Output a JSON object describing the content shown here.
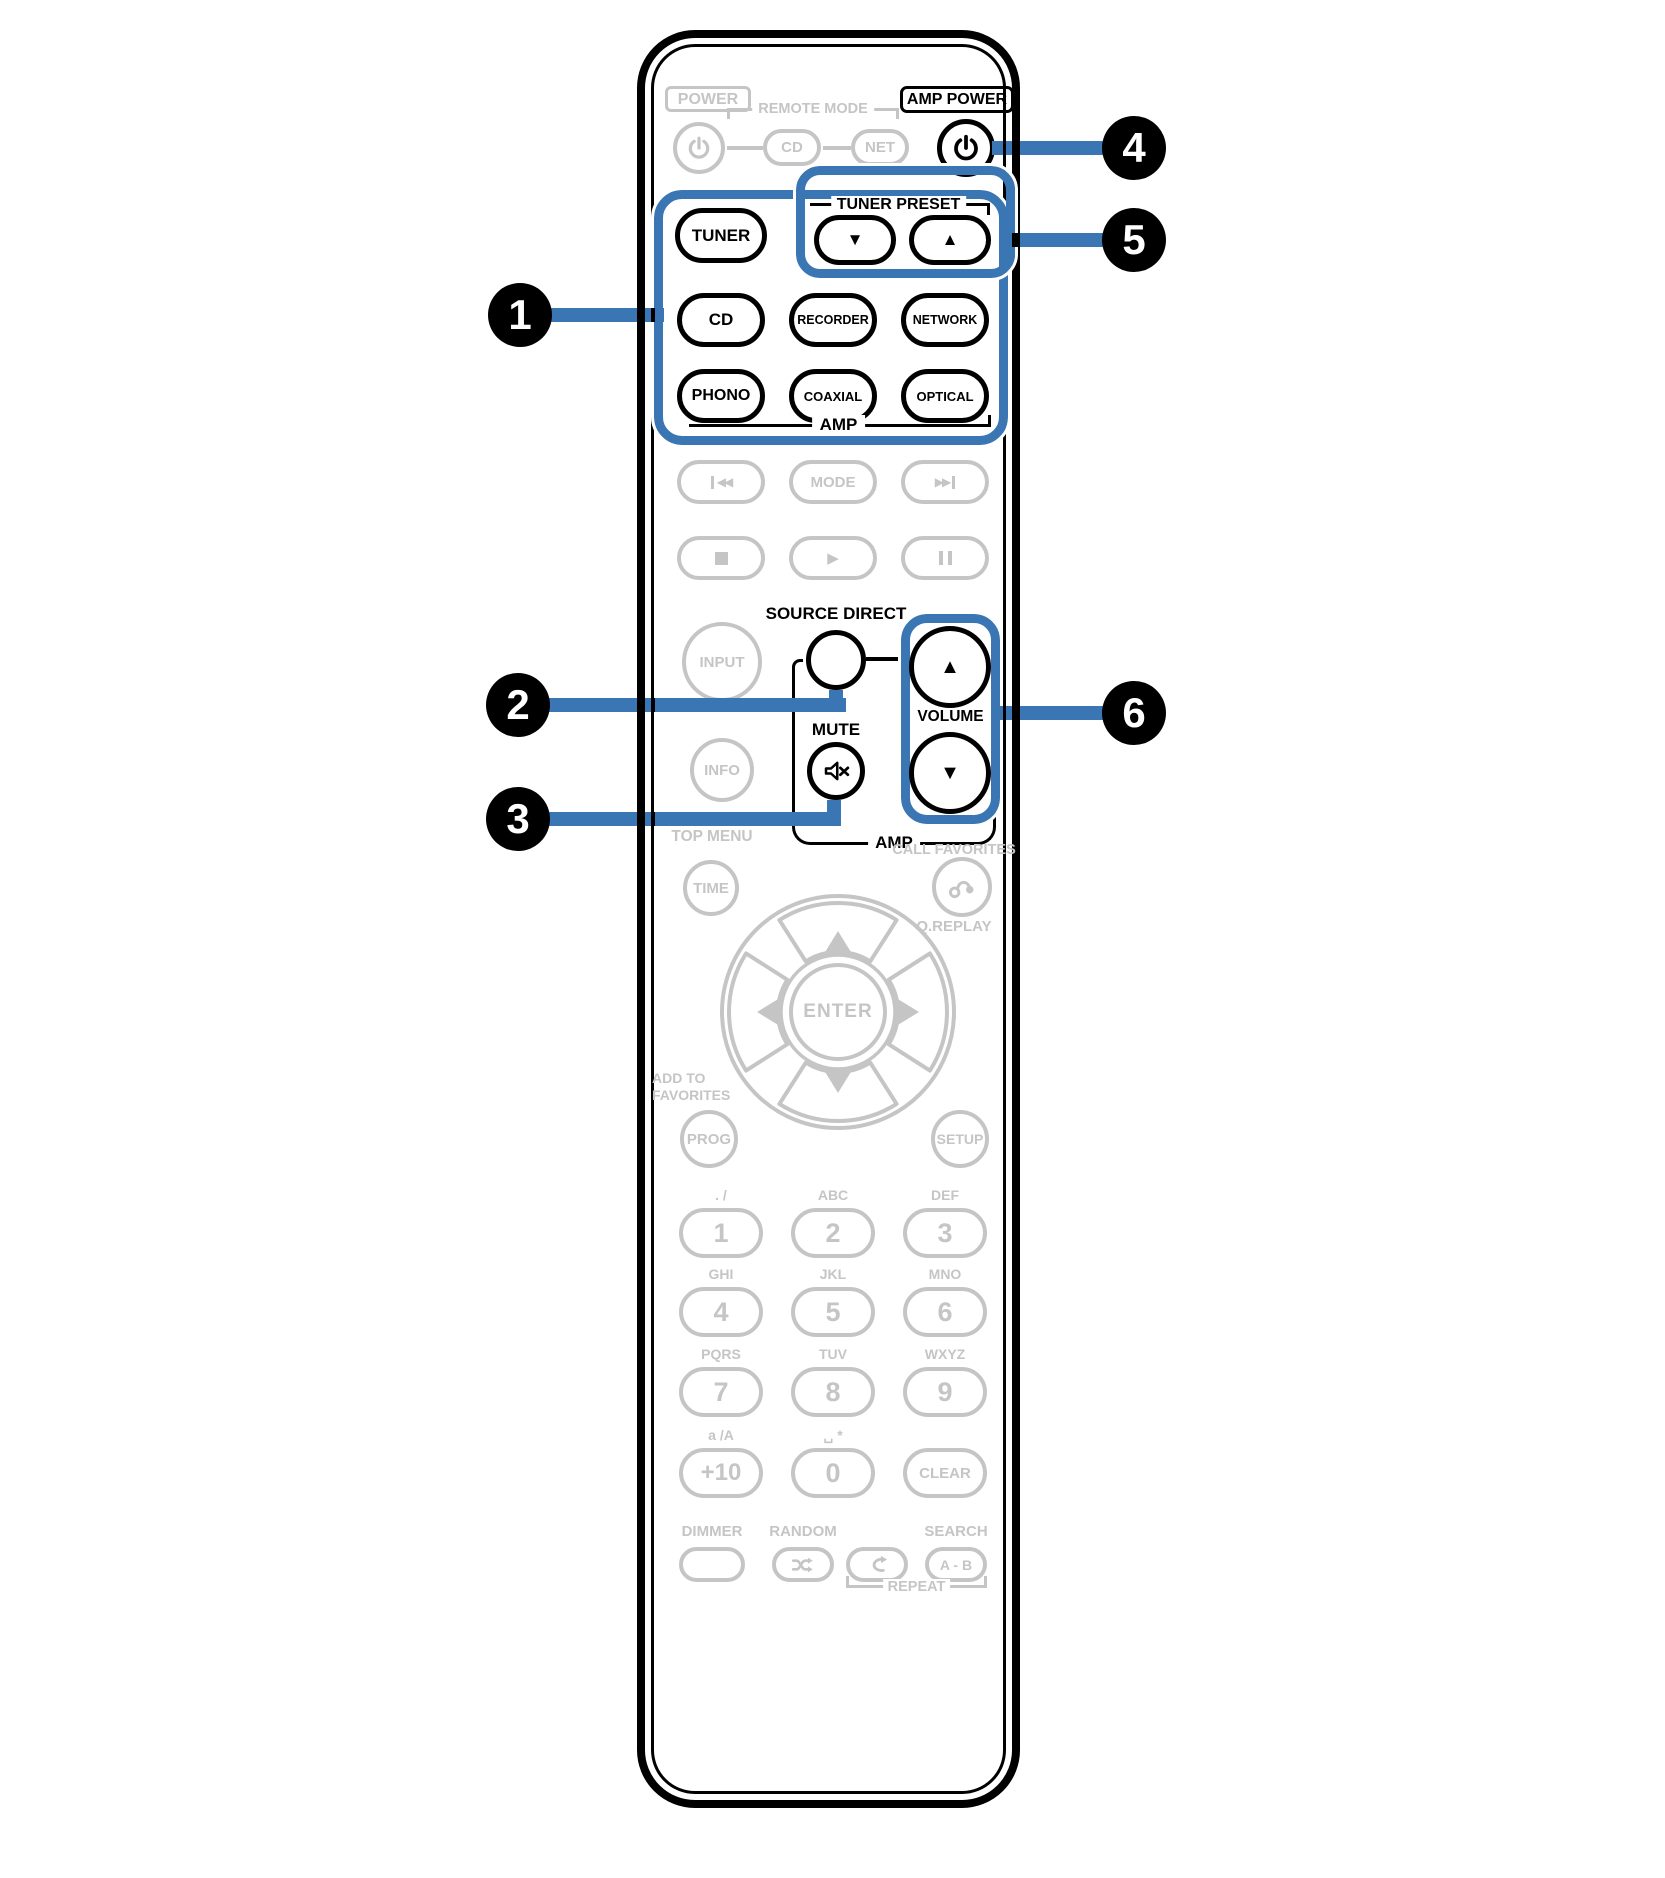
{
  "colors": {
    "accent_blue": "#3b76b4",
    "inactive_grey": "#c5c5c5",
    "active_black": "#000000"
  },
  "callouts": [
    {
      "number": "1"
    },
    {
      "number": "2"
    },
    {
      "number": "3"
    },
    {
      "number": "4"
    },
    {
      "number": "5"
    },
    {
      "number": "6"
    }
  ],
  "top": {
    "power_label": "POWER",
    "remote_mode_label": "REMOTE MODE",
    "cd_mode_button": "CD",
    "net_mode_button": "NET",
    "amp_power_label": "AMP POWER"
  },
  "tuner_preset": {
    "label": "TUNER PRESET",
    "down_glyph": "▼",
    "up_glyph": "▲"
  },
  "sources": {
    "tuner": "TUNER",
    "cd": "CD",
    "recorder": "RECORDER",
    "network": "NETWORK",
    "phono": "PHONO",
    "coaxial": "COAXIAL",
    "optical": "OPTICAL",
    "group_label": "AMP"
  },
  "transport": {
    "prev_glyph": "◀◀",
    "mode": "MODE",
    "next_glyph": "▶▶",
    "play_glyph": "▶"
  },
  "middle": {
    "input": "INPUT",
    "source_direct_label": "SOURCE DIRECT",
    "mute_label": "MUTE",
    "volume_label": "VOLUME",
    "volume_up_glyph": "▲",
    "volume_down_glyph": "▼",
    "info": "INFO",
    "group_label": "AMP"
  },
  "navigation": {
    "top_menu_label": "TOP MENU",
    "time": "TIME",
    "call_favorites_label": "CALL FAVORITES",
    "q_replay_label": "Q.REPLAY",
    "enter": "ENTER",
    "add_to_favorites_line1": "ADD TO",
    "add_to_favorites_line2": "FAVORITES",
    "prog": "PROG",
    "setup": "SETUP"
  },
  "keypad": {
    "keys": [
      {
        "label": "1",
        "hint": ". /"
      },
      {
        "label": "2",
        "hint": "ABC"
      },
      {
        "label": "3",
        "hint": "DEF"
      },
      {
        "label": "4",
        "hint": "GHI"
      },
      {
        "label": "5",
        "hint": "JKL"
      },
      {
        "label": "6",
        "hint": "MNO"
      },
      {
        "label": "7",
        "hint": "PQRS"
      },
      {
        "label": "8",
        "hint": "TUV"
      },
      {
        "label": "9",
        "hint": "WXYZ"
      },
      {
        "label": "+10",
        "hint": "a /A"
      },
      {
        "label": "0",
        "hint": "␣ *"
      },
      {
        "label": "CLEAR",
        "hint": ""
      }
    ]
  },
  "bottom": {
    "dimmer_label": "DIMMER",
    "random_label": "RANDOM",
    "search_label": "SEARCH",
    "ab_button": "A - B",
    "repeat_label": "REPEAT"
  }
}
